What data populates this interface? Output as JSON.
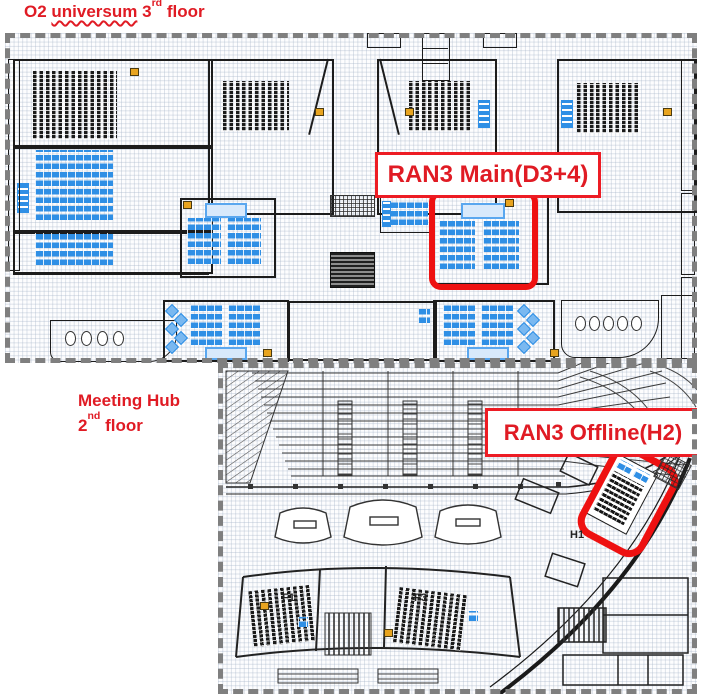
{
  "titles": {
    "plan1": {
      "prefix": "O2 ",
      "word": "universum",
      "mid": " 3",
      "ord": "rd",
      "suffix": " floor"
    },
    "plan2": {
      "line1": "Meeting Hub",
      "num": "2",
      "ord": "nd",
      "suffix": " floor"
    }
  },
  "labels": {
    "ran3_main": "RAN3 Main(D3+4)",
    "ran3_offline": "RAN3 Offline(H2)",
    "f1": "F1",
    "f3": "F3",
    "h1": "H1"
  },
  "colors": {
    "accent_red_text": "#e01b24",
    "highlight_red_box": "#ee1111",
    "table_blue": "#2f8fe5",
    "seat_black": "#1b1b1b",
    "marker_yellow": "#e8a41f",
    "dashed_border_gray": "#7f7f7f"
  }
}
